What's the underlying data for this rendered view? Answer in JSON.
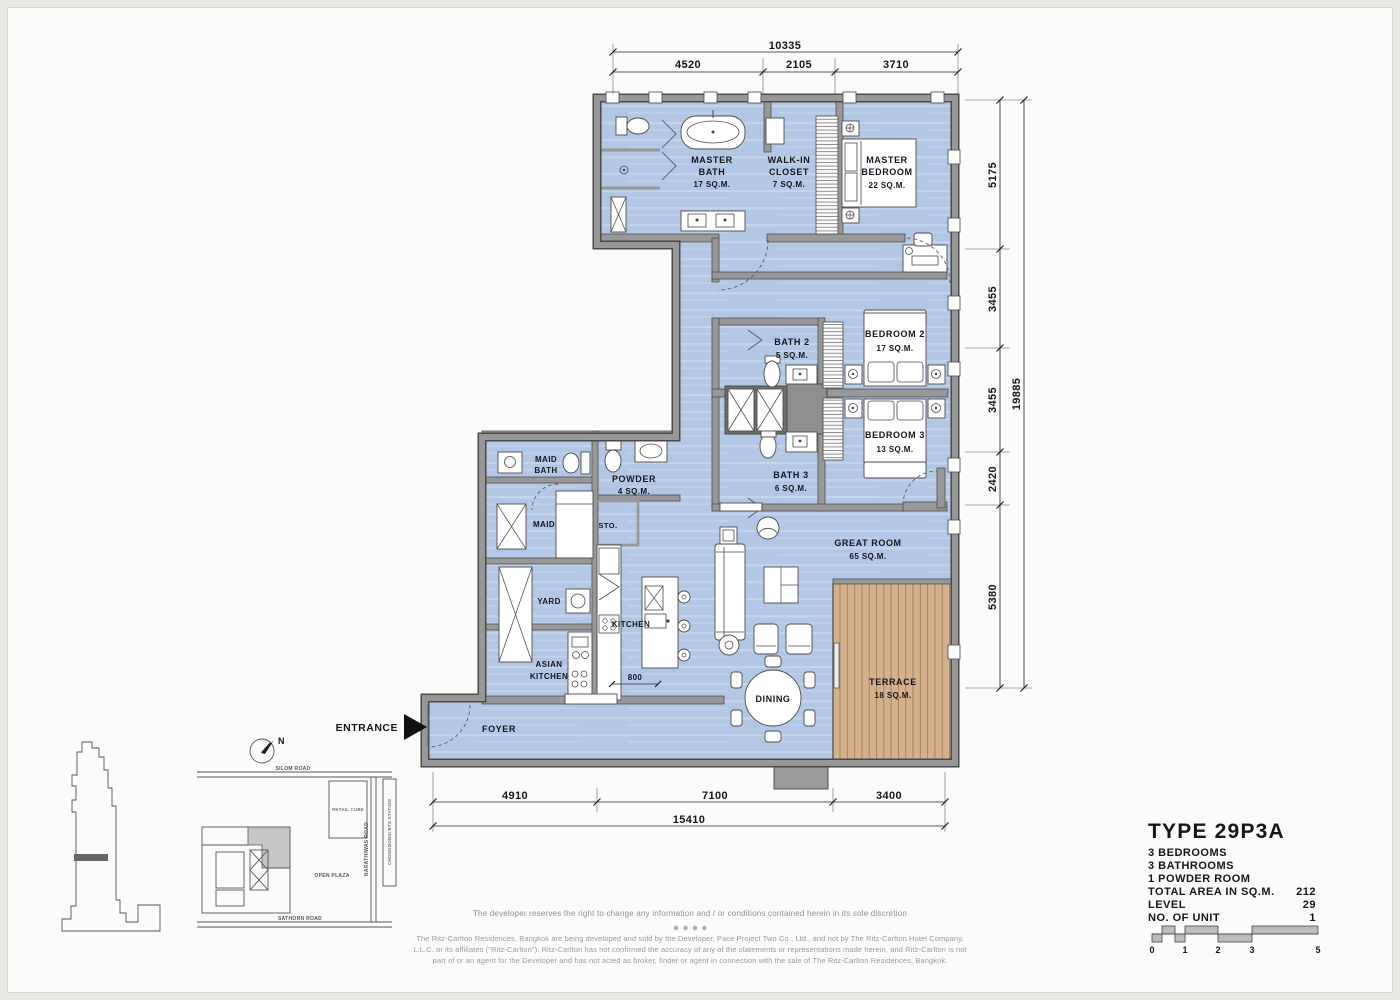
{
  "plan": {
    "rooms": {
      "master_bath": {
        "n1": "MASTER",
        "n2": "BATH",
        "area": "17 SQ.M."
      },
      "walk_in_closet": {
        "n1": "WALK-IN",
        "n2": "CLOSET",
        "area": "7 SQ.M."
      },
      "master_bedroom": {
        "n1": "MASTER",
        "n2": "BEDROOM",
        "area": "22 SQ.M."
      },
      "bath_2": {
        "n1": "BATH 2",
        "area": "5 SQ.M."
      },
      "bedroom_2": {
        "n1": "BEDROOM 2",
        "area": "17 SQ.M."
      },
      "bedroom_3": {
        "n1": "BEDROOM 3",
        "area": "13 SQ.M."
      },
      "bath_3": {
        "n1": "BATH 3",
        "area": "6 SQ.M."
      },
      "maid_bath": {
        "n1": "MAID",
        "n2": "BATH"
      },
      "powder": {
        "n1": "POWDER",
        "area": "4 SQ.M."
      },
      "maid": {
        "n1": "MAID"
      },
      "sto": {
        "n1": "STO."
      },
      "yard": {
        "n1": "YARD"
      },
      "kitchen": {
        "n1": "KITCHEN"
      },
      "asian_kitchen": {
        "n1": "ASIAN",
        "n2": "KITCHEN"
      },
      "great_room": {
        "n1": "GREAT ROOM",
        "area": "65 SQ.M."
      },
      "terrace": {
        "n1": "TERRACE",
        "area": "18 SQ.M."
      },
      "dining": {
        "n1": "DINING"
      },
      "foyer": {
        "n1": "FOYER"
      }
    },
    "entrance_label": "ENTRANCE",
    "dims": {
      "top_total": "10335",
      "top_segments": [
        "4520",
        "2105",
        "3710"
      ],
      "right_segments": [
        "5175",
        "3455",
        "3455",
        "2420",
        "5380"
      ],
      "right_total": "19885",
      "bottom_segments": [
        "4910",
        "7100",
        "3400"
      ],
      "bottom_total": "15410",
      "kitchen_island": "800"
    }
  },
  "site_map": {
    "road_top": "SILOM ROAD",
    "road_bottom": "SATHORN ROAD",
    "road_right": "NARATHIWAS ROAD",
    "bts": "CHONGNONSI BTS STATION",
    "retail_cube": "RETAIL CUBE",
    "open_plaza": "OPEN PLAZA",
    "compass": "N"
  },
  "info_block": {
    "type": "TYPE  29P3A",
    "features": [
      "3 BEDROOMS",
      "3 BATHROOMS",
      "1 POWDER ROOM"
    ],
    "rows": [
      {
        "label": "TOTAL AREA IN SQ.M.",
        "value": "212"
      },
      {
        "label": "LEVEL",
        "value": "29"
      },
      {
        "label": "NO. OF UNIT",
        "value": "1"
      }
    ],
    "scale_ticks": [
      "0",
      "1",
      "2",
      "3",
      "5"
    ]
  },
  "legal": {
    "notice": "The developer reserves the right to change any information and / or conditions contained herein in its sole discretion",
    "para1": "The Ritz-Carlton Residences, Bangkok are being developed and sold by the Developer, Pace Project Two Co., Ltd., and not by The Ritz-Carlton Hotel Company,",
    "para2": "L.L.C. or its affiliates (\"Ritz-Carlton\"). Ritz-Carlton has not confirmed the accuracy of any of the statements or representations made herein, and Ritz-Carlton is not",
    "para3": "part of or an agent for the Developer and has not acted as broker, finder or agent in connection with the sale of The Ritz-Carlton Residences, Bangkok."
  },
  "colors": {
    "floor": "#b2c7e5",
    "terrace_wood": "#d4b18c",
    "wall": "#989898"
  }
}
